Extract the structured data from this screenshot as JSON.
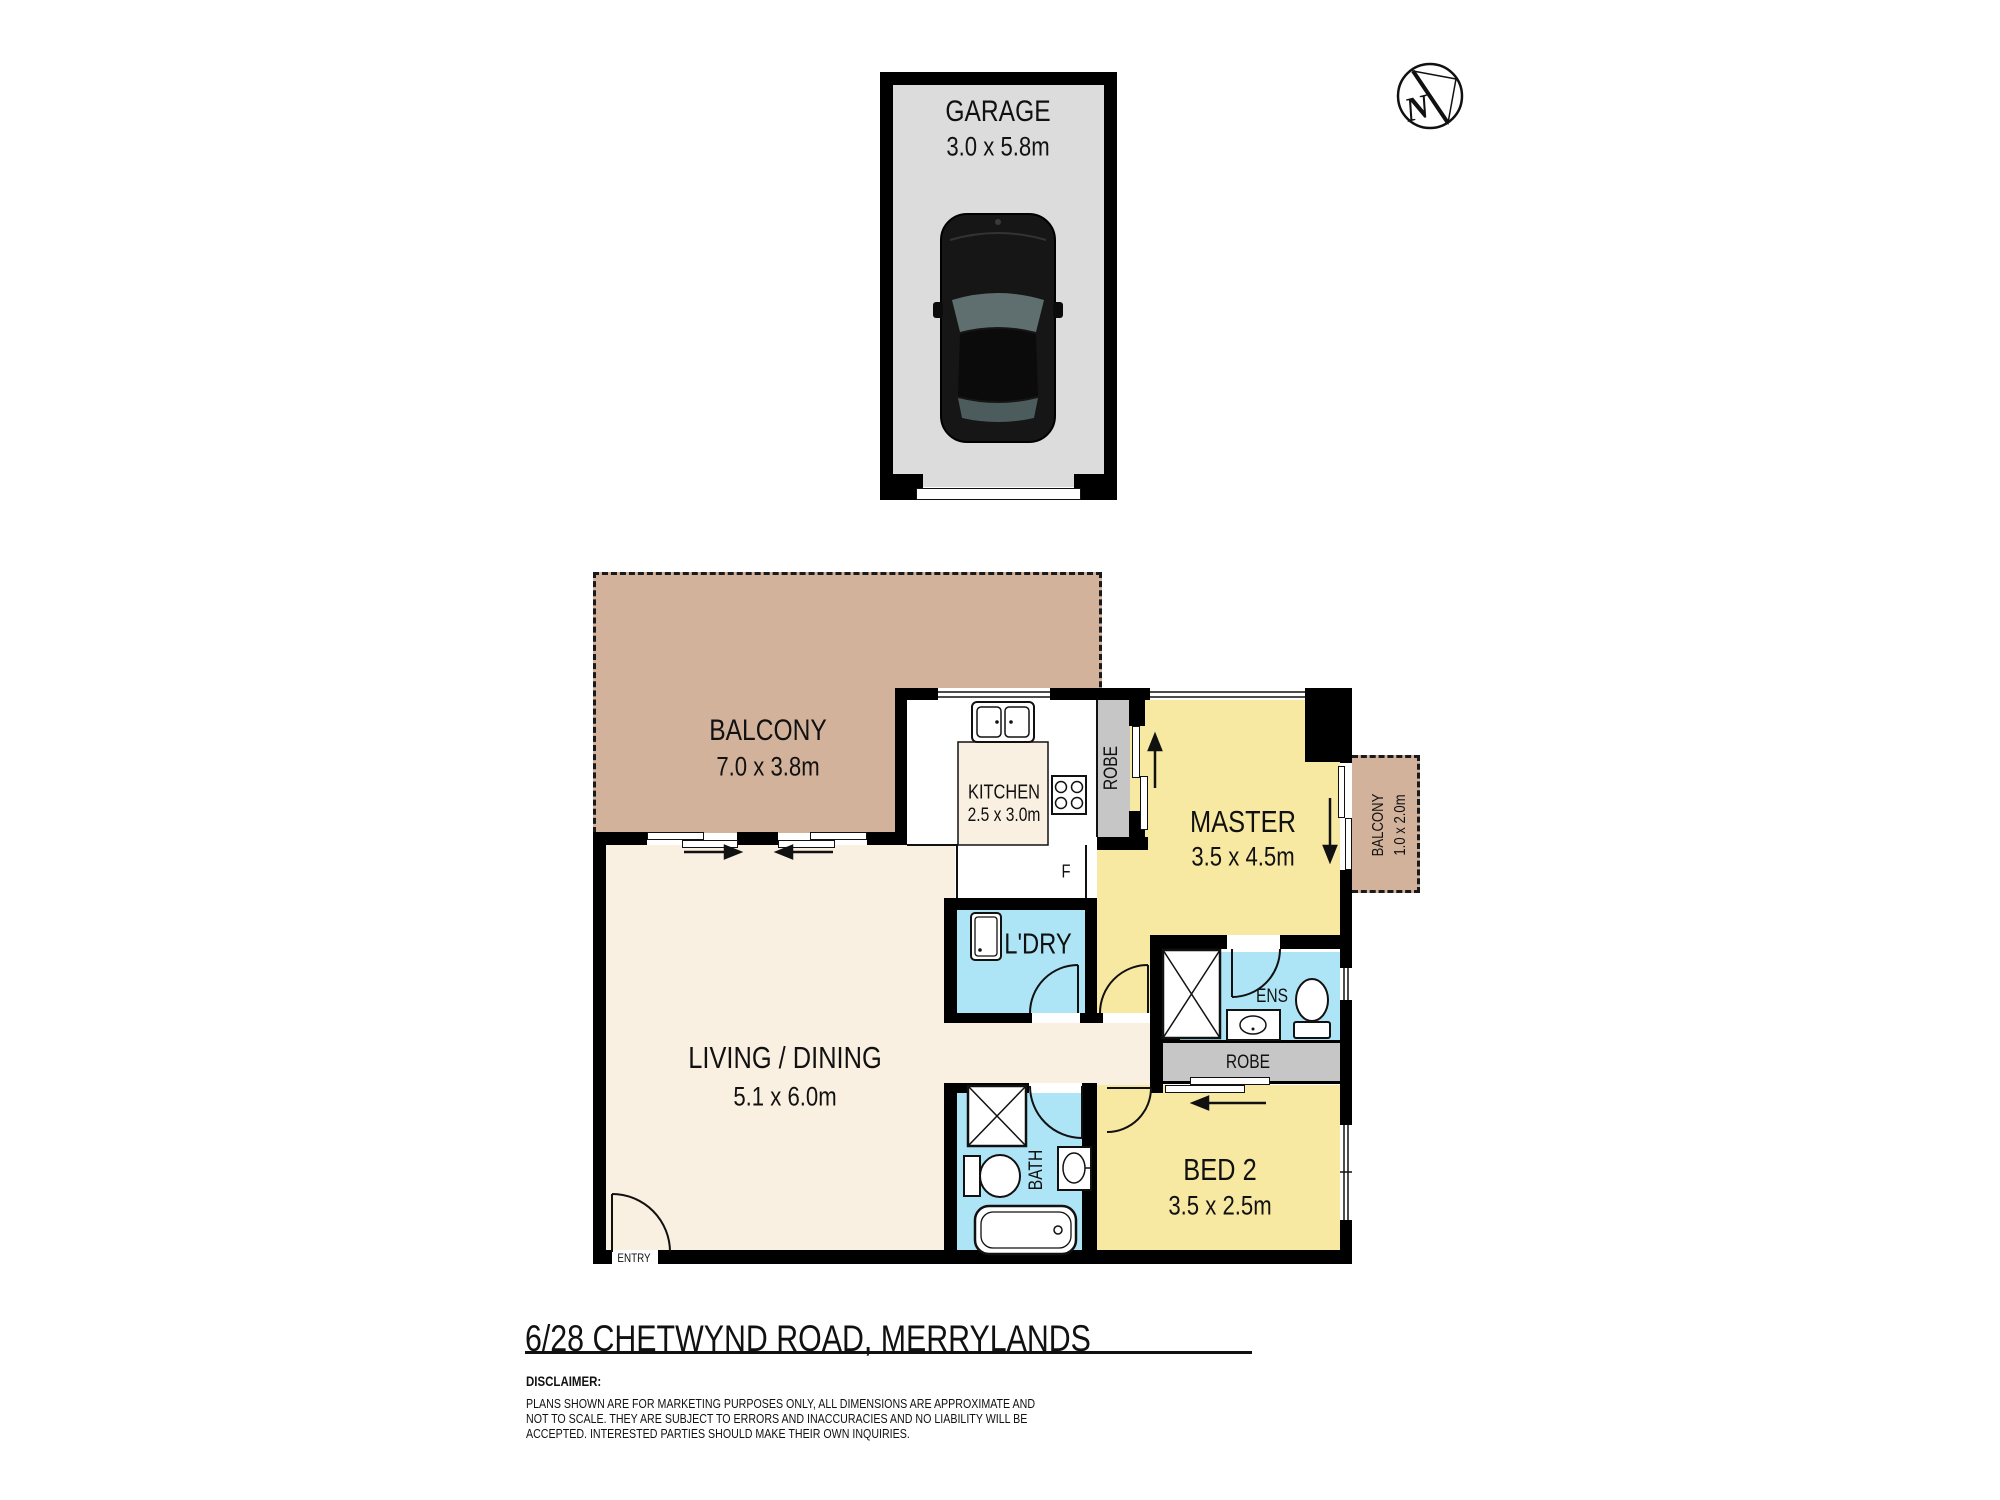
{
  "address": "6/28 CHETWYND ROAD, MERRYLANDS",
  "compass": {
    "label": "N"
  },
  "garage": {
    "name": "GARAGE",
    "dims": "3.0 x 5.8m"
  },
  "rooms": {
    "balcony_main": {
      "name": "BALCONY",
      "dims": "7.0 x 3.8m"
    },
    "kitchen": {
      "name": "KITCHEN",
      "dims": "2.5 x 3.0m"
    },
    "master": {
      "name": "MASTER",
      "dims": "3.5 x 4.5m"
    },
    "balcony_master": {
      "name": "BALCONY",
      "dims": "1.0 x 2.0m"
    },
    "laundry": {
      "name": "L'DRY"
    },
    "ensuite": {
      "name": "ENS"
    },
    "robe_master": {
      "name": "ROBE"
    },
    "robe_bed2": {
      "name": "ROBE"
    },
    "living": {
      "name": "LIVING / DINING",
      "dims": "5.1 x 6.0m"
    },
    "bath": {
      "name": "BATH"
    },
    "bed2": {
      "name": "BED 2",
      "dims": "3.5 x 2.5m"
    },
    "entry": {
      "name": "ENTRY"
    },
    "fridge": {
      "label": "F"
    }
  },
  "disclaimer": {
    "title": "DISCLAIMER:",
    "lines": [
      "PLANS SHOWN ARE FOR MARKETING PURPOSES ONLY, ALL DIMENSIONS ARE APPROXIMATE AND",
      "NOT TO SCALE. THEY ARE SUBJECT TO ERRORS AND INACCURACIES AND NO LIABILITY WILL BE",
      "ACCEPTED. INTERESTED PARTIES SHOULD MAKE THEIR OWN INQUIRIES."
    ]
  },
  "colors": {
    "wall": "#000000",
    "room_yellow": "#F8E9A2",
    "room_blue": "#ADE5F6",
    "balcony_tan": "#D2B29B",
    "floor_cream": "#FAF0E2",
    "robe_gray": "#C6C6C6",
    "garage_gray": "#DCDCDC",
    "line": "#111111"
  }
}
